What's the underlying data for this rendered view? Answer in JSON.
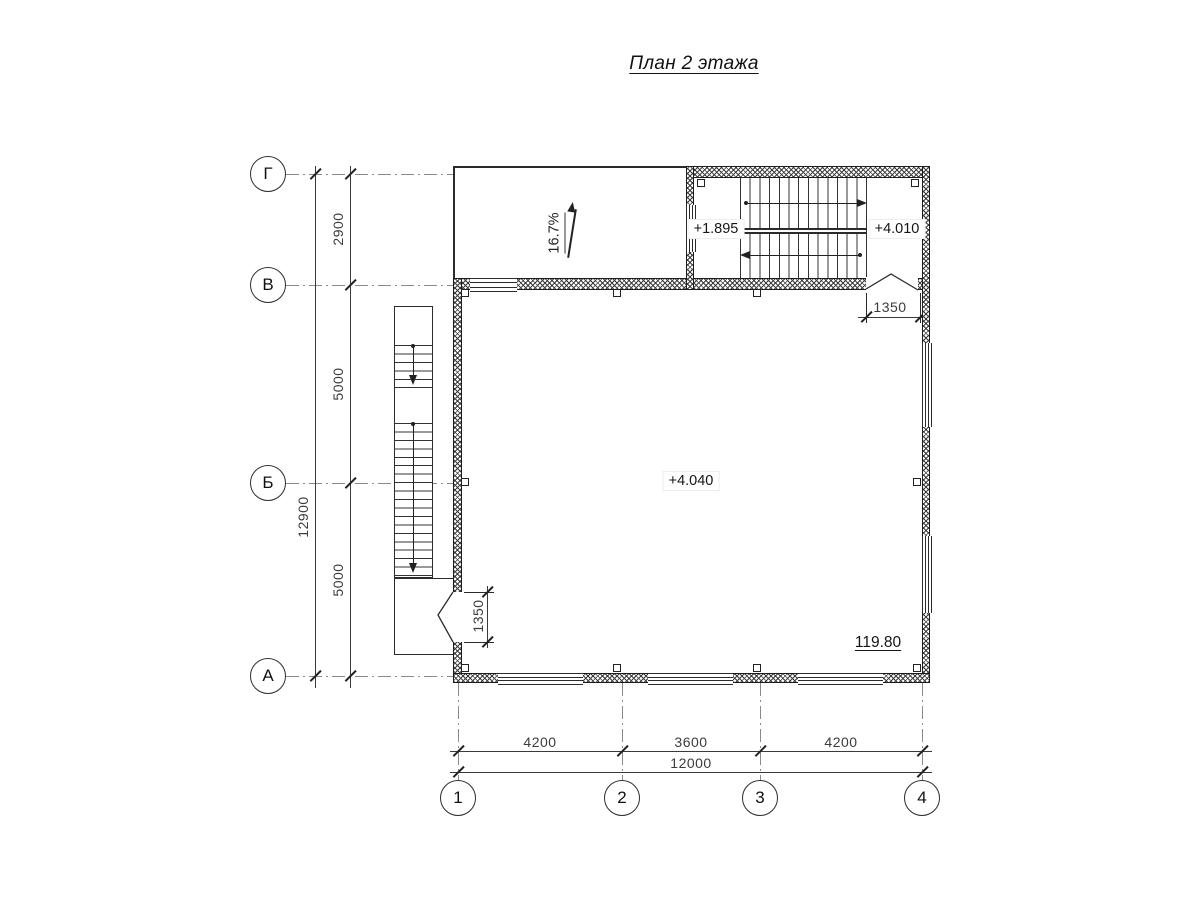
{
  "title": "План 2 этажа",
  "axes": {
    "rows": [
      {
        "label": "Г"
      },
      {
        "label": "В"
      },
      {
        "label": "Б"
      },
      {
        "label": "А"
      }
    ],
    "cols": [
      {
        "label": "1"
      },
      {
        "label": "2"
      },
      {
        "label": "3"
      },
      {
        "label": "4"
      }
    ]
  },
  "dimensions": {
    "left_overall": "12900",
    "left_segments": [
      "2900",
      "5000",
      "5000"
    ],
    "bottom_segments": [
      "4200",
      "3600",
      "4200"
    ],
    "bottom_overall": "12000",
    "left_door_width": "1350",
    "right_door_width": "1350"
  },
  "labels": {
    "ramp_slope": "16.7%",
    "elev_stair_mid_landing": "+1.895",
    "elev_stair_upper_landing": "+4.010",
    "elev_main_floor": "+4.040",
    "area_value": "119.80"
  }
}
